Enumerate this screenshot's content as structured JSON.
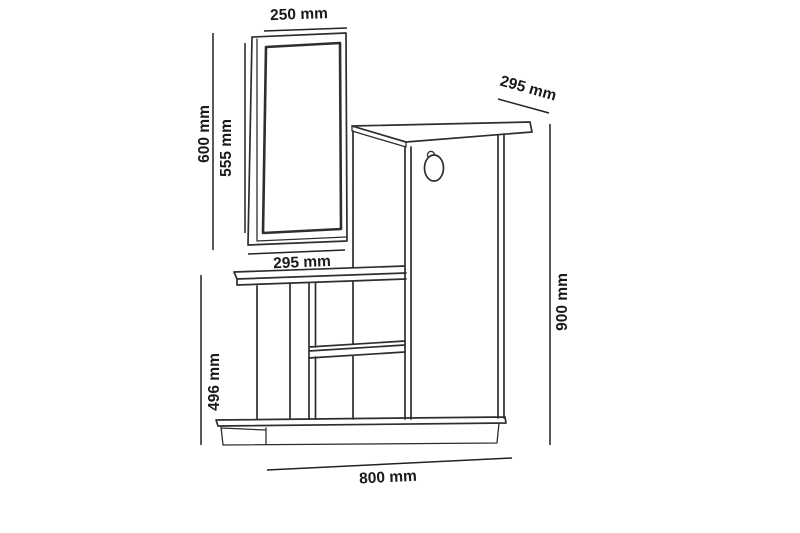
{
  "colors": {
    "background": "#ffffff",
    "line": "#2e2e2e",
    "dimension_line": "#222222",
    "text": "#1a1a1a"
  },
  "diagram": {
    "type": "furniture-dimension-drawing",
    "subject": "hallway unit with mirror, tall cabinet and open shelves",
    "labels": {
      "mirror_width": "250 mm",
      "mirror_height_outer": "600 mm",
      "mirror_height_inner": "555 mm",
      "mirror_bottom_width": "295 mm",
      "cabinet_depth": "295 mm",
      "cabinet_height": "900 mm",
      "side_unit_height": "496 mm",
      "overall_width": "800 mm"
    }
  }
}
